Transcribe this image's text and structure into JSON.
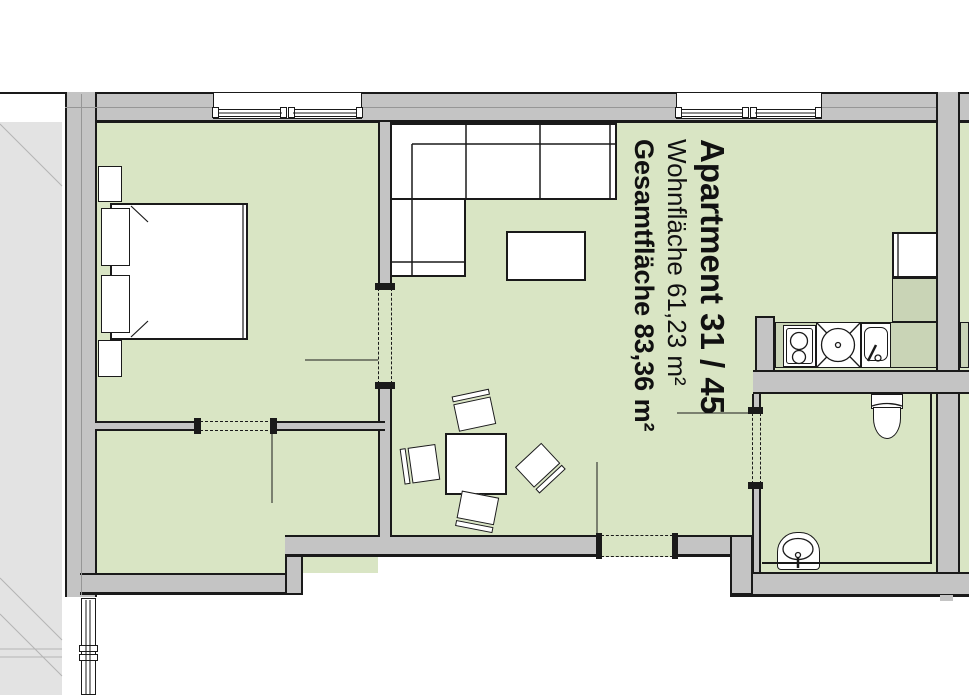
{
  "plan_label": {
    "title": "Apartment 31 / 45",
    "living_area": "Wohnfläche 61,23 m²",
    "total_area": "Gesamtfläche 83,36 m²"
  },
  "colors": {
    "floor": "#d9e5c4",
    "counter": "#c9d4b6",
    "wall": "#c4c4c4",
    "outline": "#1a1a1a",
    "adjacent_building": "#e3e3e3",
    "adjacent_line": "#b4b4b4",
    "furniture": "#ffffff",
    "background": "#ffffff"
  }
}
